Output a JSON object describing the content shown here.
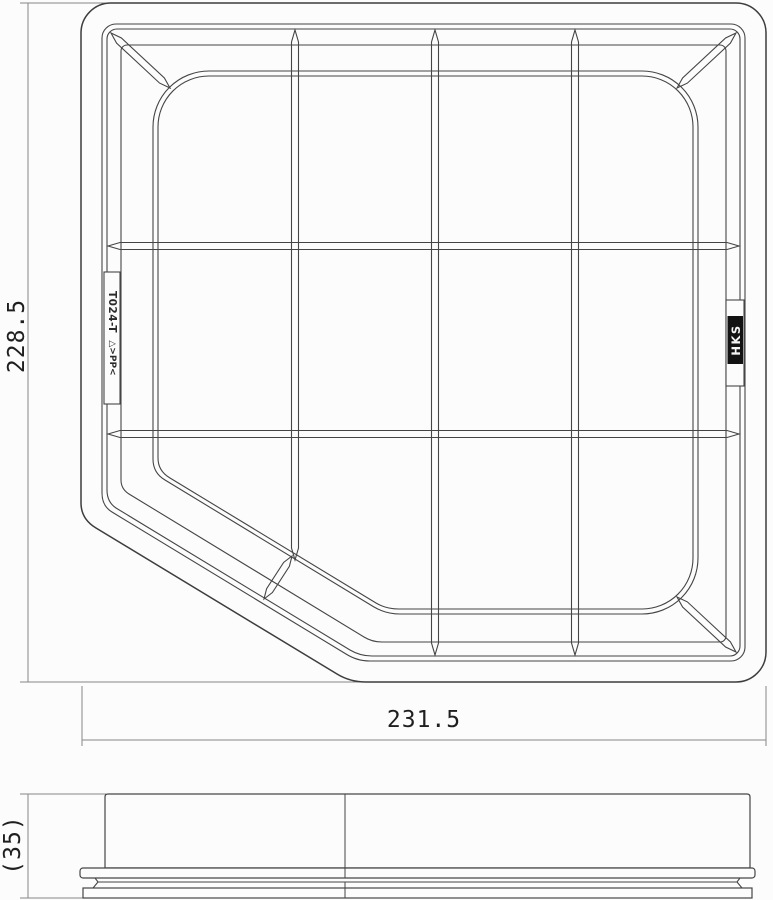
{
  "title": "Air filter element technical drawing",
  "dimensions": {
    "top_view_height": "228.5",
    "top_view_width": "231.5",
    "side_view_height": "(35)"
  },
  "markings": {
    "mold_code": "T024-T",
    "material": "△>PP<",
    "brand": "HKS"
  },
  "colors": {
    "background": "#fcfcfc",
    "line": "#454545",
    "dim_line": "#868686",
    "text": "#1f1f1f",
    "logo_bg": "#121212",
    "logo_text": "#f5f5f5"
  }
}
